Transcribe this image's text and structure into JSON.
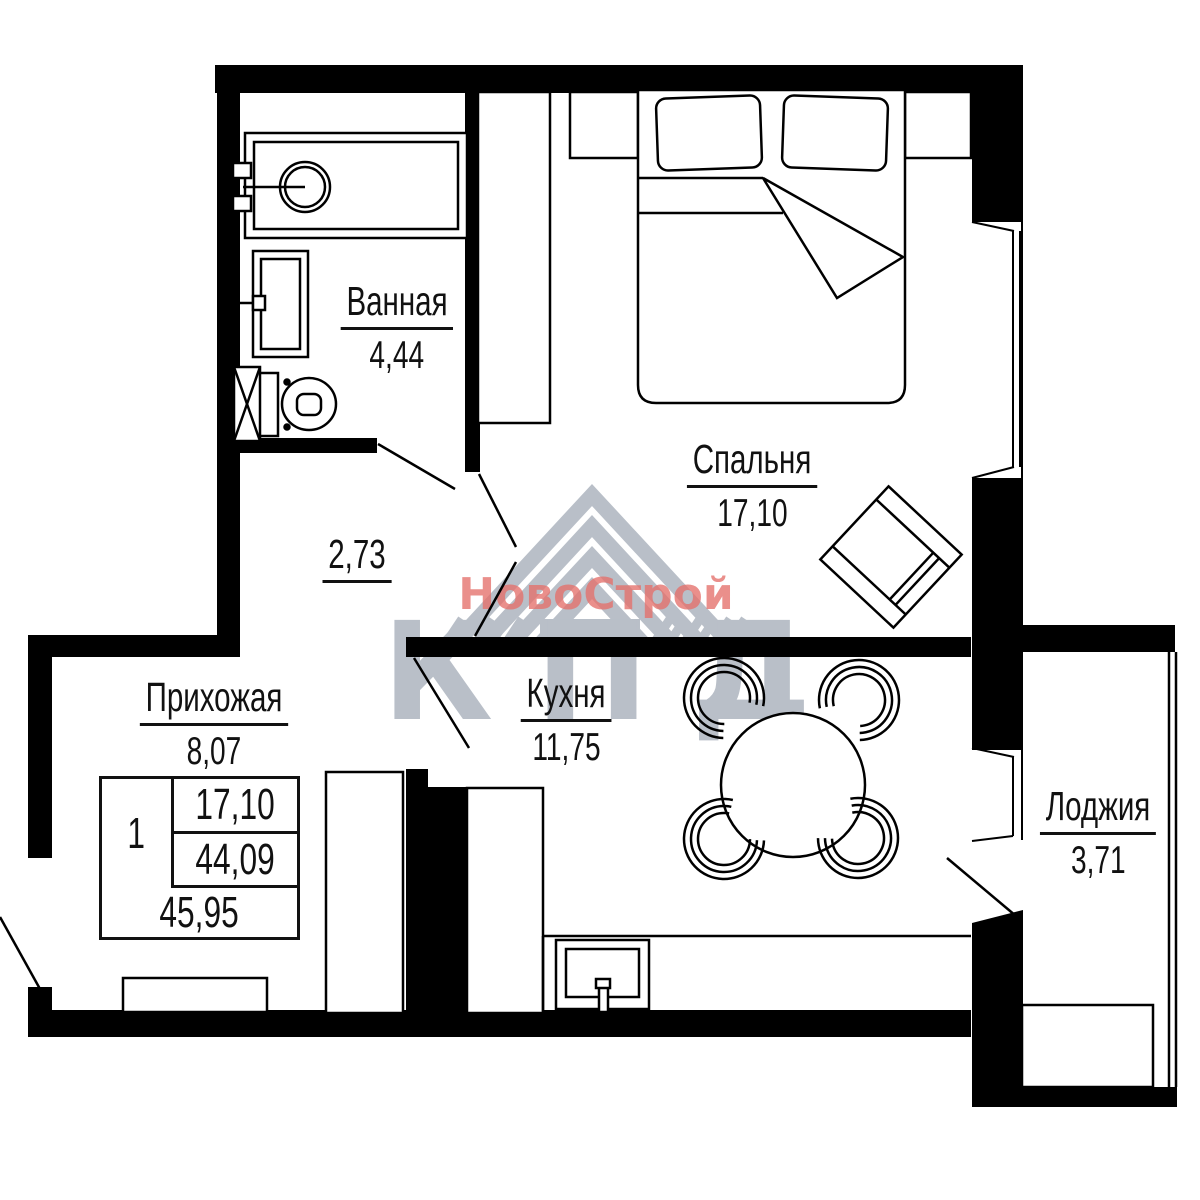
{
  "plan_title": "Однокомнатная квартира — план",
  "rooms": {
    "bathroom": {
      "name": "Ванная",
      "area": "4,44"
    },
    "bedroom": {
      "name": "Спальня",
      "area": "17,10"
    },
    "kitchen": {
      "name": "Кухня",
      "area": "11,75"
    },
    "hallway": {
      "name": "Прихожая",
      "area": "8,07"
    },
    "loggia": {
      "name": "Лоджия",
      "area": "3,71"
    },
    "corridor": {
      "area": "2,73"
    }
  },
  "spec_table": {
    "rooms_count": "1",
    "living_area": "17,10",
    "apartment_area": "44,09",
    "total_area": "45,95"
  },
  "watermark": {
    "brand": "НовоСтрой",
    "logo_text": "КПД",
    "brand_color": "#e4706a",
    "logo_color": "#b9bfc8"
  },
  "colors": {
    "walls": "#000000",
    "background": "#ffffff"
  }
}
